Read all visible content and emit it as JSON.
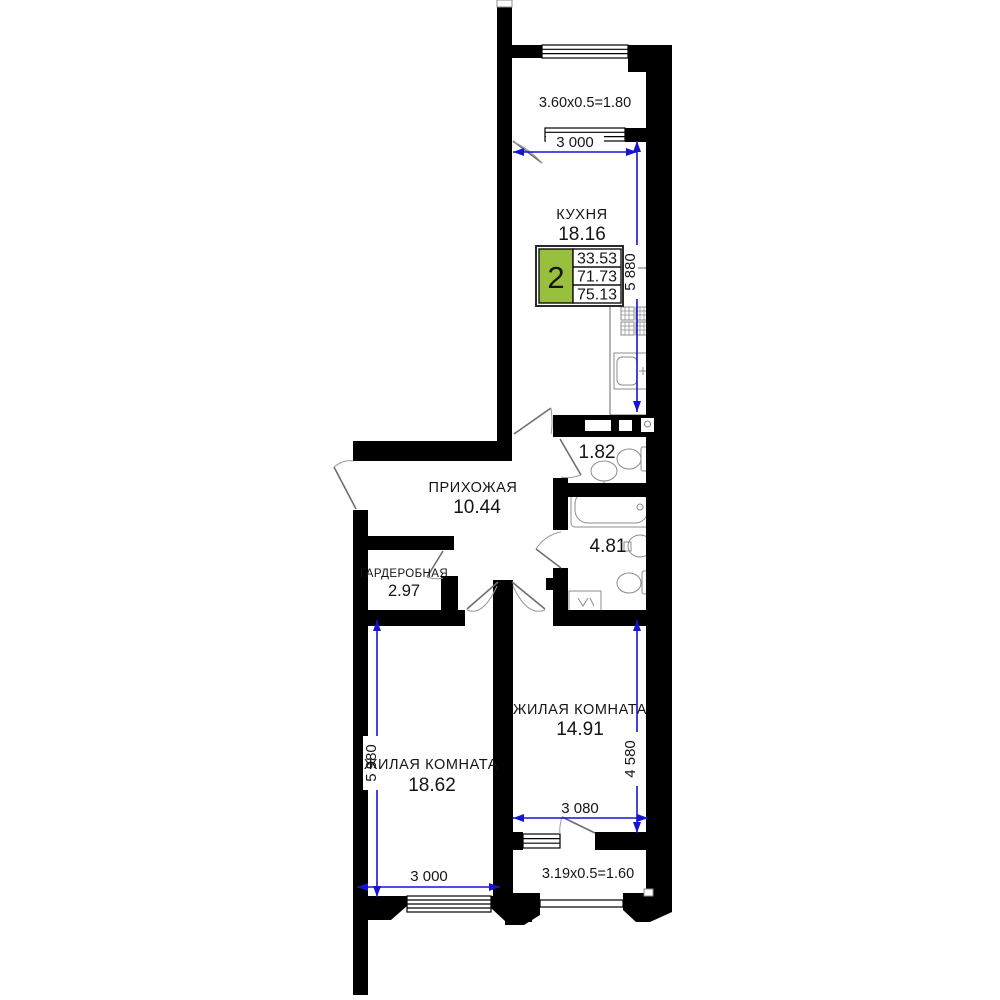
{
  "plan": {
    "summary": {
      "rooms_count": "2",
      "living_area": "33.53",
      "apartment_area": "71.73",
      "total_area": "75.13"
    },
    "rooms": {
      "kitchen": {
        "name": "КУХНЯ",
        "area": "18.16"
      },
      "hallway": {
        "name": "ПРИХОЖАЯ",
        "area": "10.44"
      },
      "wardrobe": {
        "name": "ГАРДЕРОБНАЯ",
        "area": "2.97"
      },
      "living1": {
        "name": "ЖИЛАЯ КОМНАТА",
        "area": "18.62"
      },
      "living2": {
        "name": "ЖИЛАЯ КОМНАТА",
        "area": "14.91"
      },
      "wc": {
        "area": "1.82"
      },
      "bathroom": {
        "area": "4.81"
      }
    },
    "balconies": {
      "top": {
        "label": "3.60x0.5=1.80"
      },
      "bottom": {
        "label": "3.19x0.5=1.60"
      }
    },
    "dimensions": {
      "kitchen_width": "3 000",
      "kitchen_depth": "5 880",
      "living1_depth": "5 980",
      "living1_width": "3 000",
      "living2_depth": "4 580",
      "living2_width": "3 080"
    },
    "colors": {
      "walls": "#000000",
      "dimension_lines": "#1515cf",
      "fixture_lines": "#8c8c8c",
      "summary_accent": "#98bf3e"
    }
  }
}
